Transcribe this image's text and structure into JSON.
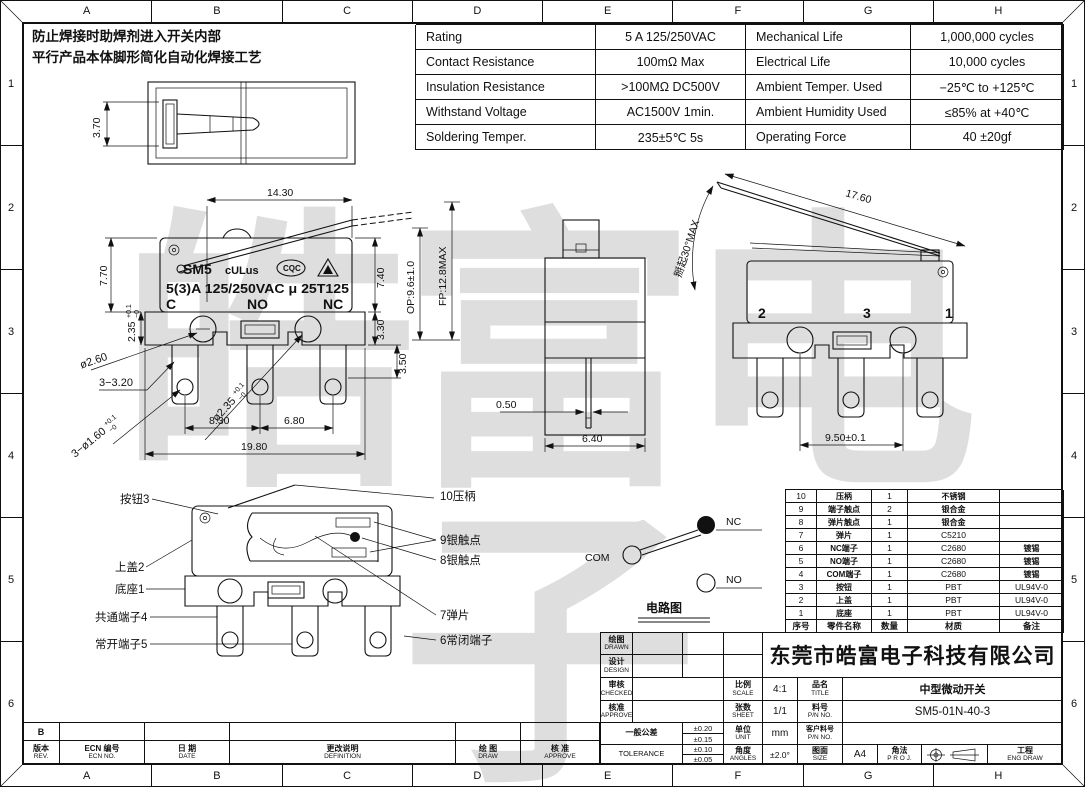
{
  "grid": {
    "cols": [
      "A",
      "B",
      "C",
      "D",
      "E",
      "F",
      "G",
      "H"
    ],
    "rows": [
      "1",
      "2",
      "3",
      "4",
      "5",
      "6"
    ]
  },
  "notes": {
    "line1": "防止焊接时助焊剂进入开关内部",
    "line2": "平行产品本体脚形简化自动化焊接工艺"
  },
  "spec": {
    "rows": [
      {
        "k1": "Rating",
        "v1": "5 A  125/250VAC",
        "k2": "Mechanical Life",
        "v2": "1,000,000 cycles"
      },
      {
        "k1": "Contact Resistance",
        "v1": "100mΩ Max",
        "k2": "Electrical Life",
        "v2": "10,000 cycles"
      },
      {
        "k1": "Insulation Resistance",
        "v1": ">100MΩ DC500V",
        "k2": "Ambient Temper. Used",
        "v2": "−25℃ to +125℃"
      },
      {
        "k1": "Withstand Voltage",
        "v1": "AC1500V  1min.",
        "k2": "Ambient Humidity Used",
        "v2": "≤85% at +40℃"
      },
      {
        "k1": "Soldering Temper.",
        "v1": "235±5℃ 5s",
        "k2": "Operating Force",
        "v2": "40 ±20gf"
      }
    ]
  },
  "marking": {
    "brand": "SM5",
    "ul": "cULus",
    "cqc": "CQC",
    "rating": "5(3)A 125/250VAC μ 25T125",
    "c": "C",
    "no": "NO",
    "nc": "NC"
  },
  "dims": {
    "top_view": {
      "h": "3.70"
    },
    "front": {
      "lever_len": "14.30",
      "body_h": "7.70",
      "base_h": "2.35",
      "tol_p": "+0.1",
      "tol_m": "−0",
      "right_h": "7.40",
      "right_base": "3.30",
      "term_shoulder": "3.50",
      "rivet_dia": "ø2.60",
      "slot": "3−3.20",
      "rivet2_dia": "ø2.35",
      "hole_dia": "3−ø1.60",
      "pitch1": "8.30",
      "pitch2": "6.80",
      "overall_w": "19.80"
    },
    "side": {
      "op": "OP:9.6±1.0",
      "fp": "FP:12.8MAX",
      "pin_w": "0.50",
      "body_w": "6.40"
    },
    "right": {
      "lever_len": "17.60",
      "angle": "掰起30°MAX",
      "pitch": "9.50±0.1",
      "t_left": "2",
      "t_mid": "3",
      "t_right": "1"
    }
  },
  "exploded": {
    "left": [
      "按钮3",
      "上盖2",
      "底座1",
      "共通端子4",
      "常开端子5"
    ],
    "right": [
      "10压柄",
      "9银触点",
      "8银触点",
      "7弹片",
      "6常闭端子"
    ]
  },
  "circuit": {
    "com": "COM",
    "nc": "NC",
    "no": "NO",
    "caption": "电路图"
  },
  "bom": {
    "rows": [
      [
        "10",
        "压柄",
        "1",
        "不锈钢",
        ""
      ],
      [
        "9",
        "端子触点",
        "2",
        "银合金",
        ""
      ],
      [
        "8",
        "弹片触点",
        "1",
        "银合金",
        ""
      ],
      [
        "7",
        "弹片",
        "1",
        "C5210",
        ""
      ],
      [
        "6",
        "NC端子",
        "1",
        "C2680",
        "镀锡"
      ],
      [
        "5",
        "NO端子",
        "1",
        "C2680",
        "镀锡"
      ],
      [
        "4",
        "COM端子",
        "1",
        "C2680",
        "镀锡"
      ],
      [
        "3",
        "按钮",
        "1",
        "PBT",
        "UL94V-0"
      ],
      [
        "2",
        "上盖",
        "1",
        "PBT",
        "UL94V-0"
      ],
      [
        "1",
        "底座",
        "1",
        "PBT",
        "UL94V-0"
      ]
    ],
    "footer": [
      "序号",
      "零件名称",
      "数量",
      "材质",
      "备注"
    ]
  },
  "title_block": {
    "company": "东莞市皓富电子科技有限公司",
    "drawn_cn": "绘图",
    "drawn_en": "DRAWN",
    "design_cn": "设计",
    "design_en": "DESIGN",
    "checked_cn": "审核",
    "checked_en": "CHECKED",
    "approve_cn": "核准",
    "approve_en": "APPROVE",
    "tol_cn": "一般公差",
    "tol_en": "TOLERANCE",
    "tol1": "±0.20",
    "tol2": "±0.15",
    "tol3": "±0.10",
    "tol4": "±0.05",
    "scale_cn": "比例",
    "scale_en": "SCALE",
    "scale_v": "4:1",
    "sheet_cn": "张数",
    "sheet_en": "SHEET",
    "sheet_v": "1/1",
    "unit_cn": "单位",
    "unit_en": "UNIT",
    "unit_v": "mm",
    "angles_cn": "角度",
    "angles_en": "ANGLES",
    "angles_v": "±2.0°",
    "title_cn": "品名",
    "title_en": "TITLE",
    "title_v": "中型微动开关",
    "pn_cn": "料号",
    "pn_en": "P/N NO.",
    "pn_v": "SM5-01N-40-3",
    "cpn_cn": "客户料号",
    "cpn_en": "P/N NO.",
    "cpn_v": "",
    "size_cn": "图面",
    "size_en": "SIZE",
    "size_v": "A4",
    "proj_cn": "角法",
    "proj_en": "P R O J.",
    "eng_cn": "工程",
    "eng_en": "ENG DRAW"
  },
  "revision": {
    "rev_v": "B",
    "rev_cn": "版本",
    "rev_en": "REV.",
    "ecn_cn": "ECN 编号",
    "ecn_en": "ECN NO.",
    "date_cn": "日 期",
    "date_en": "DATE",
    "def_cn": "更改说明",
    "def_en": "DEFINITION",
    "draw_cn": "绘 图",
    "draw_en": "DRAW",
    "appr_cn": "核 准",
    "appr_en": "APPROVE"
  },
  "watermark": "皓富电子"
}
